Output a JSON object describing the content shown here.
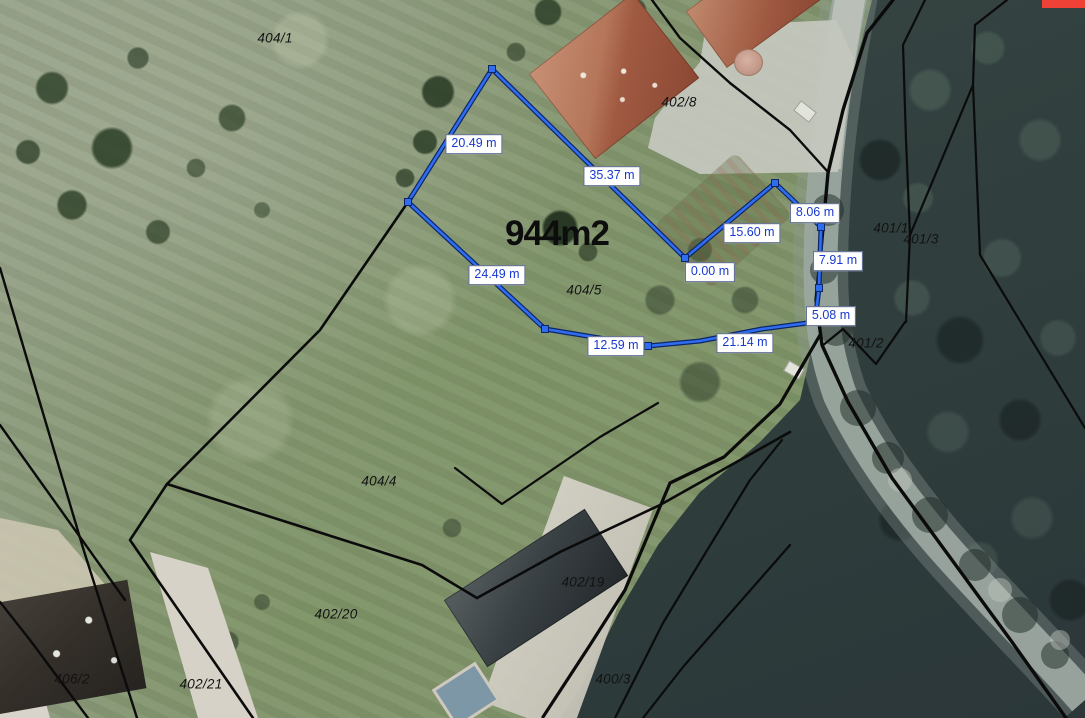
{
  "map": {
    "area_label": {
      "text": "944m2",
      "x": 557,
      "y": 234
    },
    "parcel_labels": [
      {
        "label": "404/1",
        "x": 275,
        "y": 38
      },
      {
        "label": "402/8",
        "x": 679,
        "y": 102
      },
      {
        "label": "401/1",
        "x": 891,
        "y": 228
      },
      {
        "label": "401/3",
        "x": 921,
        "y": 239
      },
      {
        "label": "401/2",
        "x": 866,
        "y": 343
      },
      {
        "label": "404/5",
        "x": 584,
        "y": 290
      },
      {
        "label": "404/4",
        "x": 379,
        "y": 481
      },
      {
        "label": "402/19",
        "x": 583,
        "y": 582
      },
      {
        "label": "402/20",
        "x": 336,
        "y": 614
      },
      {
        "label": "402/21",
        "x": 201,
        "y": 684
      },
      {
        "label": "406/2",
        "x": 72,
        "y": 679
      },
      {
        "label": "400/3",
        "x": 613,
        "y": 679
      }
    ],
    "measurement_labels": [
      {
        "label": "20.49 m",
        "x": 474,
        "y": 144
      },
      {
        "label": "35.37 m",
        "x": 612,
        "y": 176
      },
      {
        "label": "15.60 m",
        "x": 752,
        "y": 233
      },
      {
        "label": "8.06 m",
        "x": 815,
        "y": 213
      },
      {
        "label": "0.00 m",
        "x": 710,
        "y": 272
      },
      {
        "label": "7.91 m",
        "x": 838,
        "y": 261
      },
      {
        "label": "5.08 m",
        "x": 831,
        "y": 316
      },
      {
        "label": "21.14 m",
        "x": 745,
        "y": 343
      },
      {
        "label": "12.59 m",
        "x": 616,
        "y": 346
      },
      {
        "label": "24.49 m",
        "x": 497,
        "y": 275
      }
    ],
    "measure_polygon": {
      "points": [
        [
          492,
          69
        ],
        [
          408,
          202
        ],
        [
          545,
          329
        ],
        [
          648,
          346
        ],
        [
          700,
          341
        ],
        [
          762,
          329
        ],
        [
          815,
          322
        ],
        [
          819,
          288
        ],
        [
          821,
          227
        ],
        [
          775,
          183
        ],
        [
          685,
          258
        ],
        [
          492,
          69
        ]
      ],
      "vertices": [
        [
          492,
          69
        ],
        [
          408,
          202
        ],
        [
          545,
          329
        ],
        [
          648,
          346
        ],
        [
          815,
          322
        ],
        [
          819,
          288
        ],
        [
          821,
          227
        ],
        [
          775,
          183
        ],
        [
          685,
          258
        ]
      ]
    },
    "boundaries": [
      {
        "points": [
          [
            0,
            268
          ],
          [
            83,
            548
          ],
          [
            137,
            718
          ]
        ],
        "w": 2.4
      },
      {
        "points": [
          [
            0,
            425
          ],
          [
            125,
            600
          ]
        ],
        "w": 2.4
      },
      {
        "points": [
          [
            0,
            602
          ],
          [
            30,
            640
          ],
          [
            88,
            718
          ]
        ],
        "w": 2.4
      },
      {
        "points": [
          [
            167,
            484
          ],
          [
            130,
            540
          ],
          [
            197,
            637
          ],
          [
            253,
            718
          ]
        ],
        "w": 2.6
      },
      {
        "points": [
          [
            408,
            202
          ],
          [
            320,
            330
          ],
          [
            167,
            484
          ],
          [
            422,
            565
          ],
          [
            477,
            598
          ]
        ],
        "w": 2.6
      },
      {
        "points": [
          [
            477,
            598
          ],
          [
            560,
            552
          ],
          [
            660,
            505
          ],
          [
            790,
            432
          ]
        ],
        "w": 2.6
      },
      {
        "points": [
          [
            455,
            468
          ],
          [
            502,
            504
          ],
          [
            600,
            437
          ],
          [
            658,
            403
          ]
        ],
        "w": 2.2
      },
      {
        "points": [
          [
            652,
            0
          ],
          [
            680,
            38
          ],
          [
            730,
            83
          ],
          [
            790,
            130
          ],
          [
            828,
            172
          ]
        ],
        "w": 2.4
      },
      {
        "points": [
          [
            893,
            0
          ],
          [
            867,
            33
          ],
          [
            843,
            110
          ],
          [
            828,
            173
          ],
          [
            821,
            250
          ],
          [
            816,
            300
          ],
          [
            822,
            345
          ],
          [
            848,
            402
          ],
          [
            892,
            478
          ],
          [
            952,
            560
          ],
          [
            1012,
            642
          ],
          [
            1066,
            718
          ]
        ],
        "w": 3.4
      },
      {
        "points": [
          [
            925,
            0
          ],
          [
            903,
            45
          ],
          [
            906,
            140
          ],
          [
            910,
            235
          ],
          [
            906,
            322
          ]
        ],
        "w": 2.2
      },
      {
        "points": [
          [
            1007,
            0
          ],
          [
            975,
            25
          ],
          [
            973,
            85
          ],
          [
            910,
            235
          ]
        ],
        "w": 2.2
      },
      {
        "points": [
          [
            973,
            85
          ],
          [
            980,
            255
          ],
          [
            1085,
            428
          ]
        ],
        "w": 2.2
      },
      {
        "points": [
          [
            905,
            322
          ],
          [
            876,
            364
          ],
          [
            843,
            329
          ],
          [
            822,
            346
          ]
        ],
        "w": 2.2
      },
      {
        "points": [
          [
            820,
            335
          ],
          [
            780,
            404
          ],
          [
            724,
            457
          ],
          [
            670,
            483
          ],
          [
            625,
            590
          ],
          [
            590,
            645
          ],
          [
            543,
            717
          ]
        ],
        "w": 3.2
      },
      {
        "points": [
          [
            782,
            440
          ],
          [
            750,
            480
          ],
          [
            703,
            557
          ],
          [
            663,
            623
          ],
          [
            615,
            718
          ]
        ],
        "w": 2.2
      },
      {
        "points": [
          [
            790,
            545
          ],
          [
            683,
            667
          ],
          [
            643,
            718
          ]
        ],
        "w": 2.2
      }
    ],
    "colors": {
      "boundary_black": "#0b0b0b",
      "measure_blue": "#2f6df0",
      "measure_casing": "#0e2566",
      "label_text_blue": "#1839cf",
      "label_border": "#55648a",
      "accent_red": "#ef4136"
    }
  }
}
